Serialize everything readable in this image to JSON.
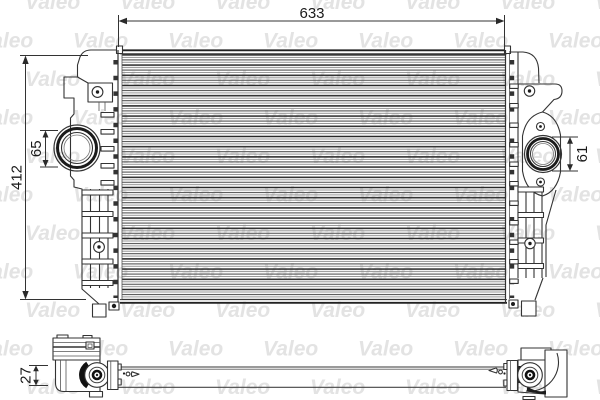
{
  "watermark": {
    "text": "Valeo",
    "color": "#e3e3e3"
  },
  "dimensions": {
    "overall_width": "633",
    "overall_height": "412",
    "left_port": "65",
    "right_port": "61",
    "depth": "27"
  },
  "colors": {
    "background": "#ffffff",
    "line": "#333333",
    "dark_fill": "#1c1c1c",
    "bar_top": "#9a9a9a"
  }
}
